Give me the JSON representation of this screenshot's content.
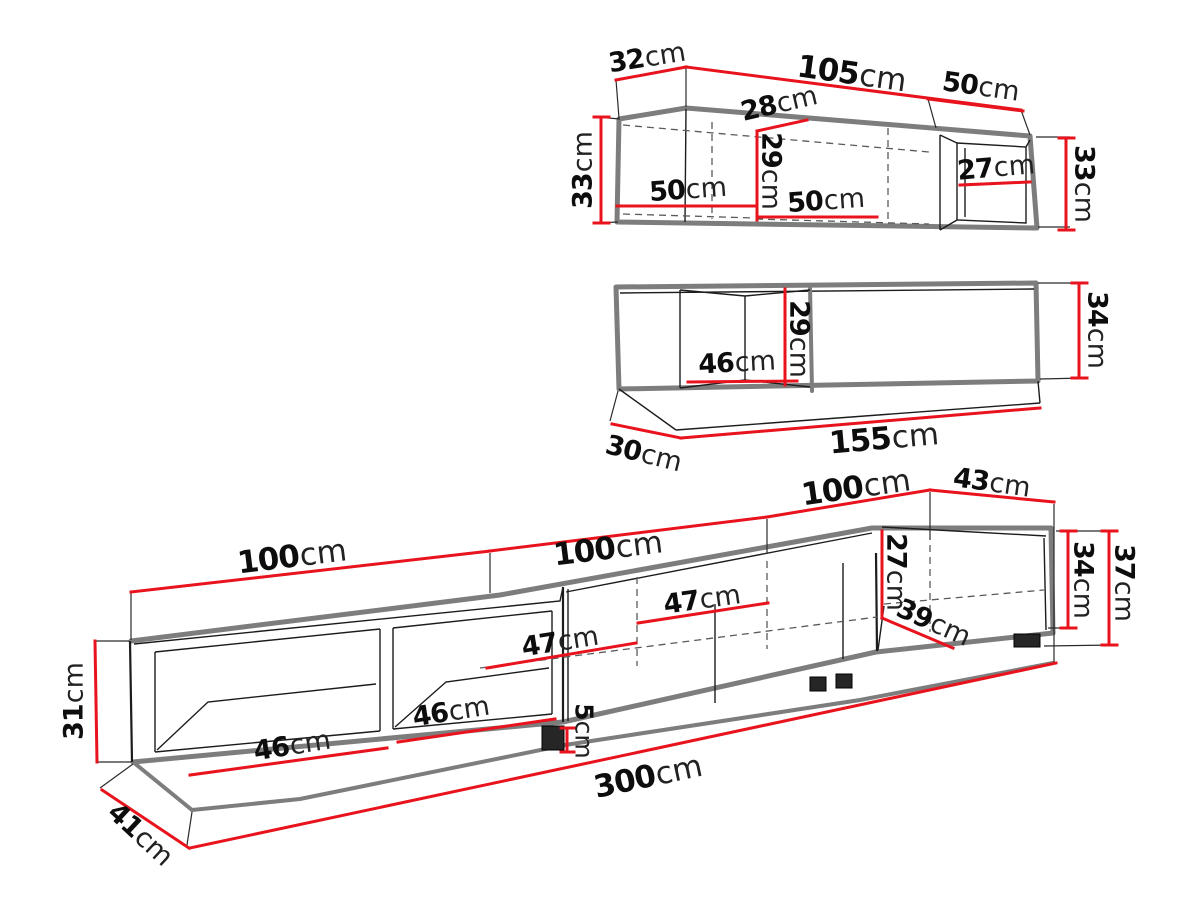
{
  "meta": {
    "image_type": "furniture dimension diagram",
    "unit": "cm",
    "colors": {
      "dimension_red": "#e8131d",
      "outline_gray": "#7d7d7d",
      "line_black": "#1c1c1c",
      "dashed_gray": "#5a5a5a",
      "background": "#ffffff"
    }
  },
  "top_cabinet": {
    "depth_left": {
      "v": "32",
      "u": "cm"
    },
    "width_front": {
      "v": "105",
      "u": "cm"
    },
    "width_right": {
      "v": "50",
      "u": "cm"
    },
    "height_left": {
      "v": "33",
      "u": "cm"
    },
    "depth_inner": {
      "v": "28",
      "u": "cm"
    },
    "height_inner": {
      "v": "29",
      "u": "cm"
    },
    "width_inner_left": {
      "v": "50",
      "u": "cm"
    },
    "width_inner_mid": {
      "v": "50",
      "u": "cm"
    },
    "width_inner_right": {
      "v": "27",
      "u": "cm"
    },
    "height_right": {
      "v": "33",
      "u": "cm"
    }
  },
  "mid_cabinet": {
    "width_niche": {
      "v": "46",
      "u": "cm"
    },
    "height_niche": {
      "v": "29",
      "u": "cm"
    },
    "height_right": {
      "v": "34",
      "u": "cm"
    },
    "depth": {
      "v": "30",
      "u": "cm"
    },
    "width_total": {
      "v": "155",
      "u": "cm"
    }
  },
  "tv_stand": {
    "width_1": {
      "v": "100",
      "u": "cm"
    },
    "width_2": {
      "v": "100",
      "u": "cm"
    },
    "width_3": {
      "v": "100",
      "u": "cm"
    },
    "depth_top": {
      "v": "43",
      "u": "cm"
    },
    "height_left": {
      "v": "31",
      "u": "cm"
    },
    "niche_1_width": {
      "v": "46",
      "u": "cm"
    },
    "niche_2_width": {
      "v": "46",
      "u": "cm"
    },
    "door_1_width": {
      "v": "47",
      "u": "cm"
    },
    "door_2_width": {
      "v": "47",
      "u": "cm"
    },
    "niche_right_height": {
      "v": "27",
      "u": "cm"
    },
    "niche_right_width": {
      "v": "39",
      "u": "cm"
    },
    "height_body": {
      "v": "34",
      "u": "cm"
    },
    "height_total": {
      "v": "37",
      "u": "cm"
    },
    "foot_height": {
      "v": "5",
      "u": "cm"
    },
    "depth_left": {
      "v": "41",
      "u": "cm"
    },
    "width_total": {
      "v": "300",
      "u": "cm"
    }
  }
}
